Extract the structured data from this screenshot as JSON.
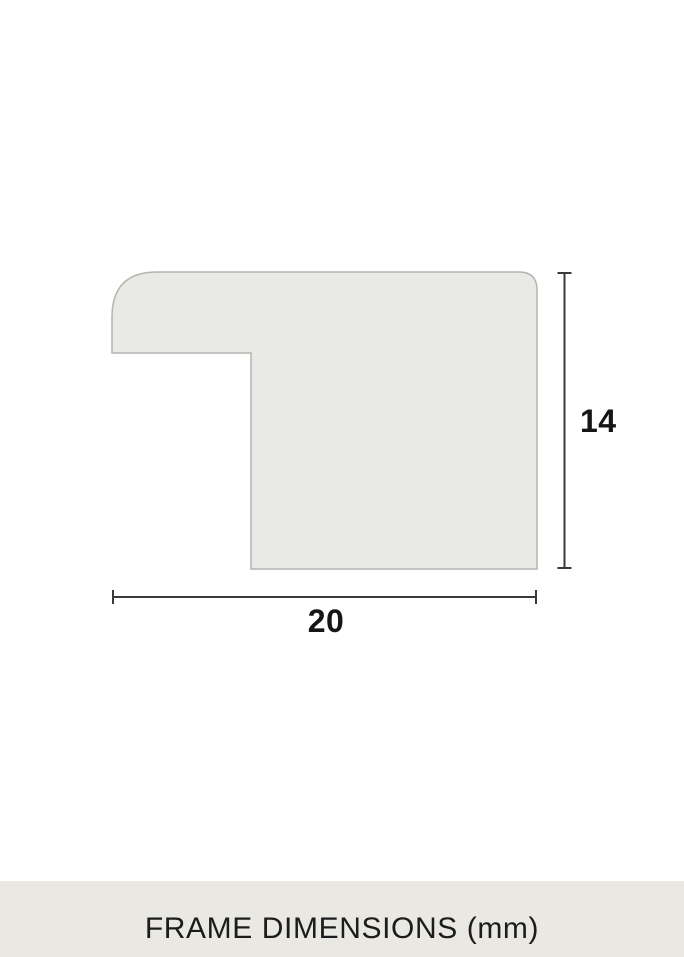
{
  "diagram": {
    "name": "frame-profile-cross-section",
    "height_dimension": {
      "label": "14"
    },
    "width_dimension": {
      "label": "20"
    }
  },
  "footer": {
    "label": "FRAME DIMENSIONS (mm)"
  },
  "colors": {
    "page_background": "#FFFFFF",
    "shape_fill": "#E9E9E5",
    "shape_stroke": "#B4B4AF",
    "dimension_line": "#3A3A3A",
    "label_text": "#161616",
    "footer_background": "#E9E8E3",
    "footer_text": "#1C1C1C"
  }
}
